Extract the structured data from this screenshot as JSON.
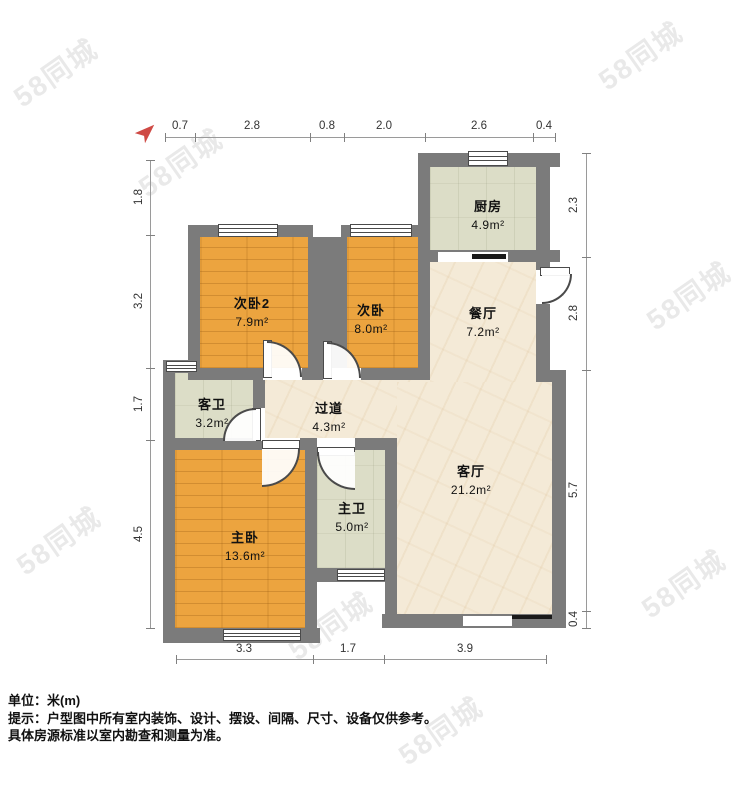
{
  "watermark": {
    "text": "58同城"
  },
  "compass": {
    "label": "north-arrow",
    "color": "#cf4a45"
  },
  "rooms": [
    {
      "id": "kitchen",
      "name": "厨房",
      "area": "4.9m²"
    },
    {
      "id": "dining",
      "name": "餐厅",
      "area": "7.2m²"
    },
    {
      "id": "bedroom2",
      "name": "次卧2",
      "area": "7.9m²"
    },
    {
      "id": "bedroom",
      "name": "次卧",
      "area": "8.0m²"
    },
    {
      "id": "guest-bath",
      "name": "客卫",
      "area": "3.2m²"
    },
    {
      "id": "hallway",
      "name": "过道",
      "area": "4.3m²"
    },
    {
      "id": "master-bedroom",
      "name": "主卧",
      "area": "13.6m²"
    },
    {
      "id": "master-bath",
      "name": "主卫",
      "area": "5.0m²"
    },
    {
      "id": "living",
      "name": "客厅",
      "area": "21.2m²"
    }
  ],
  "dimensions": {
    "top": [
      "0.7",
      "2.8",
      "0.8",
      "2.0",
      "2.6",
      "0.4"
    ],
    "left": [
      "1.8",
      "3.2",
      "1.7",
      "4.5"
    ],
    "right": [
      "2.3",
      "2.8",
      "5.7",
      "0.4"
    ],
    "bottom": [
      "3.3",
      "1.7",
      "3.9"
    ]
  },
  "footer": {
    "unit": "单位：米(m)",
    "tip": "提示：户型图中所有室内装饰、设计、摆设、间隔、尺寸、设备仅供参考。",
    "note": "具体房源标准以室内勘查和测量为准。"
  },
  "colors": {
    "wall": "#7b7b7b",
    "wood_floor": "#eca43f",
    "tile_floor": "#dcddc7",
    "marble_floor": "#f4ead7"
  }
}
